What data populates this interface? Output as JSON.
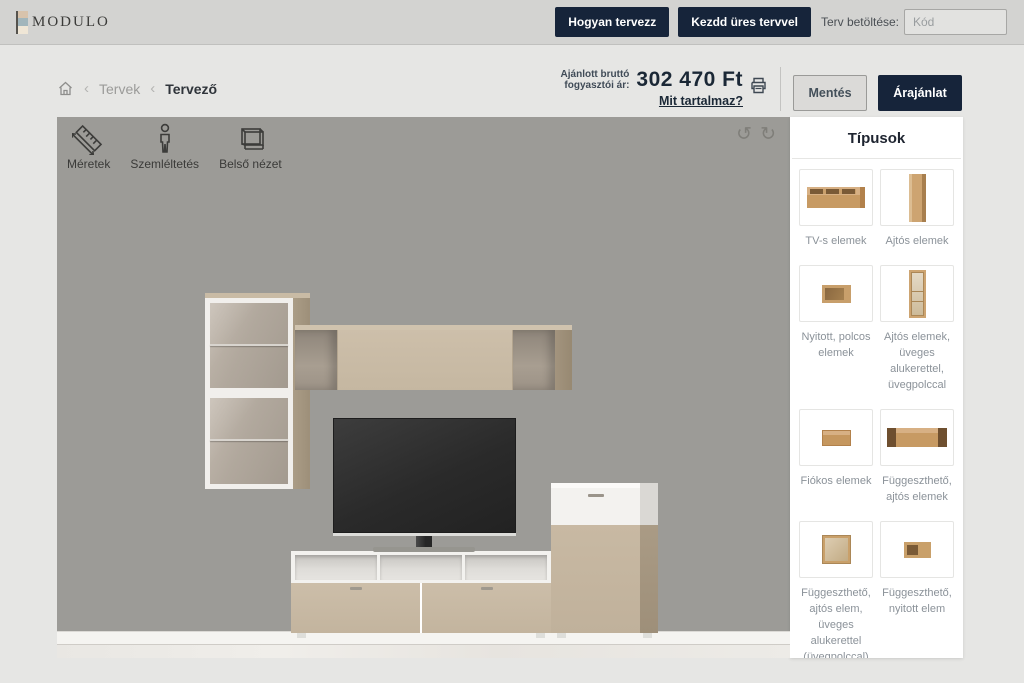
{
  "header": {
    "logo_text": "MODULO",
    "how_to_button": "Hogyan tervezz",
    "start_empty_button": "Kezdd üres tervvel",
    "load_plan_label": "Terv betöltése:",
    "code_placeholder": "Kód"
  },
  "breadcrumb": {
    "separator": "‹",
    "plans": "Tervek",
    "designer": "Tervező"
  },
  "price": {
    "label_line1": "Ajánlott bruttó",
    "label_line2": "fogyasztói ár:",
    "amount": "302 470 Ft",
    "details_link": "Mit tartalmaz?"
  },
  "actions": {
    "save_button": "Mentés",
    "quote_button": "Árajánlat"
  },
  "canvas_tools": {
    "dimensions": "Méretek",
    "illustration": "Szemléltetés",
    "interior_view": "Belső nézet",
    "undo_glyph": "↺",
    "redo_glyph": "↻"
  },
  "sidebar": {
    "title": "Típusok",
    "items": [
      {
        "label": "TV-s elemek"
      },
      {
        "label": "Ajtós elemek"
      },
      {
        "label": "Nyitott, polcos elemek"
      },
      {
        "label": "Ajtós elemek, üveges alukerettel, üvegpolccal"
      },
      {
        "label": "Fiókos elemek"
      },
      {
        "label": "Függeszthető, ajtós elemek"
      },
      {
        "label": "Függeszthető, ajtós elem, üveges alukerettel (üvegpolccal)"
      },
      {
        "label": "Függeszthető, nyitott elem"
      }
    ]
  },
  "colors": {
    "navy": "#16243a",
    "wall": "#9c9b97",
    "beige_front": "#c5b7a1",
    "wood_thumb": "#c89f6b"
  }
}
